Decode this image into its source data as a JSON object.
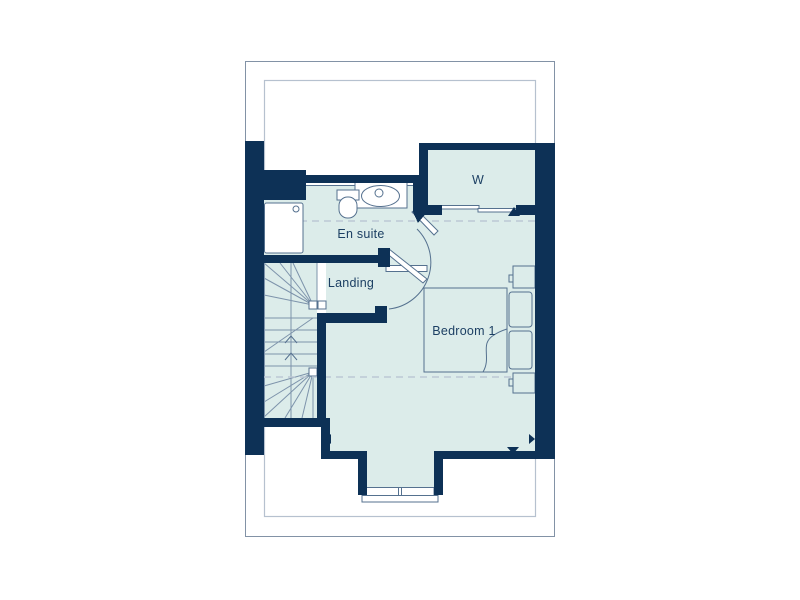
{
  "plan_type": "floor-plan",
  "rooms": [
    {
      "id": "en-suite",
      "label": "En suite"
    },
    {
      "id": "landing",
      "label": "Landing"
    },
    {
      "id": "wardrobe",
      "label": "W"
    },
    {
      "id": "bedroom-1",
      "label": "Bedroom 1"
    }
  ],
  "fixtures": [
    "shower-tray",
    "toilet",
    "basin",
    "staircase-winder",
    "double-bed",
    "pillows",
    "built-in-cupboards",
    "sliding-wardrobe-doors",
    "dormer-window",
    "door-swing-arc",
    "reduced-head-height-dashed-lines"
  ],
  "colors": {
    "wall": "#0d3156",
    "floor": "#dcecea",
    "fixture_line": "#55718f",
    "dashed_line": "#bcc8d4",
    "label_text": "#1c3f63",
    "plot_border": "#8292a6",
    "footprint_outline": "#b6c1cf"
  }
}
